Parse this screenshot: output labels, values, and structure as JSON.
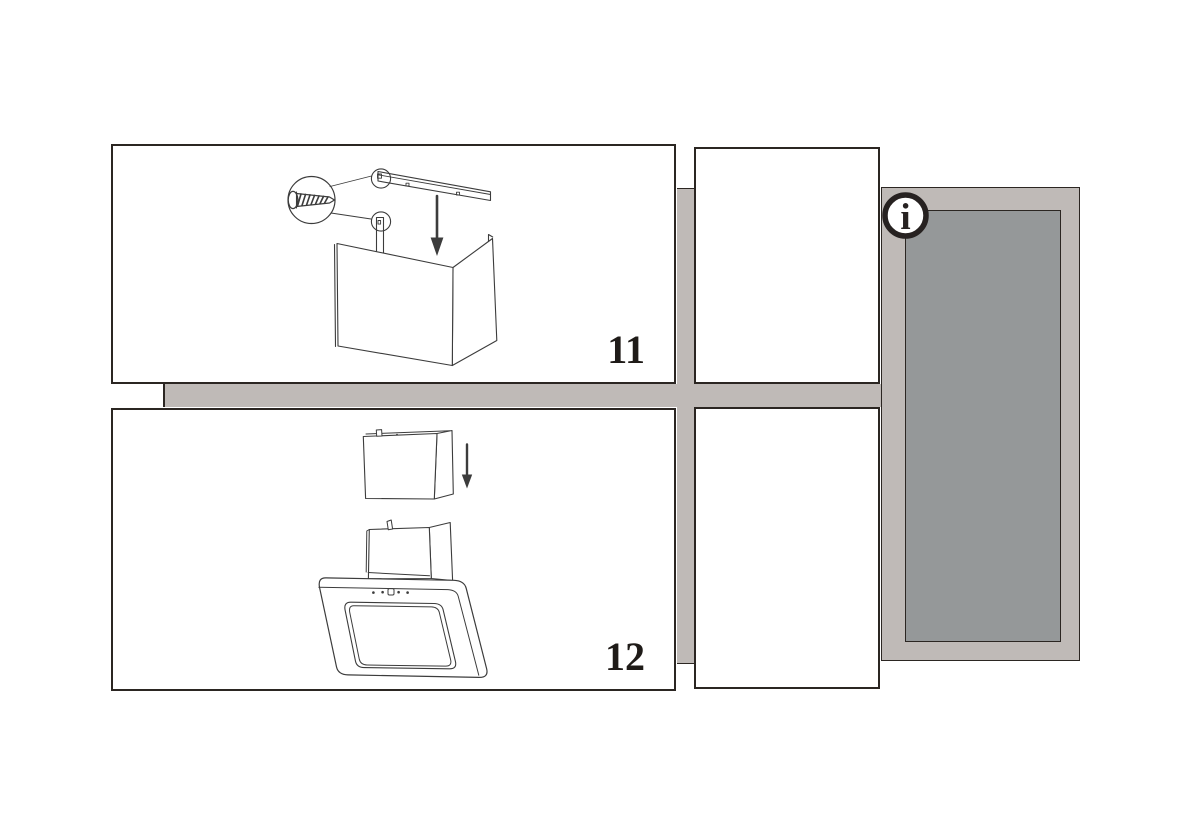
{
  "colors": {
    "background": "#ffffff",
    "panel_border": "#2b2622",
    "line_art": "#3c3c3c",
    "connector": "#bfbab7",
    "info_fill": "#959899",
    "info_ring": "#272221",
    "text": "#1f1b18"
  },
  "steps": [
    {
      "label": "11"
    },
    {
      "label": "12"
    }
  ],
  "info": {
    "symbol": "i"
  }
}
